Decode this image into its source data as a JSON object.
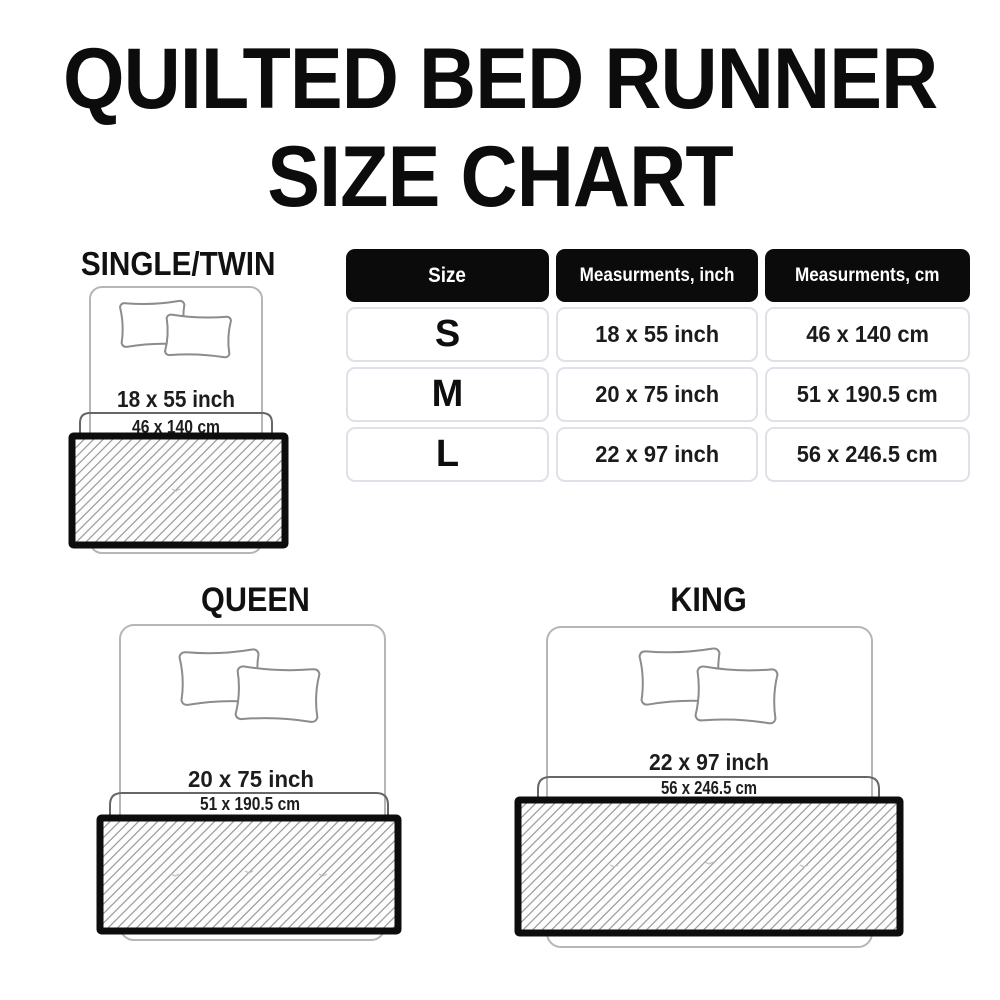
{
  "title": {
    "line1": "QUILTED BED RUNNER",
    "line2": "SIZE CHART"
  },
  "size_table": {
    "headers": {
      "size": "Size",
      "inch": "Measurments, inch",
      "cm": "Measurments, cm"
    },
    "rows": [
      {
        "size": "S",
        "inch": "18 x 55 inch",
        "cm": "46 x 140 cm"
      },
      {
        "size": "M",
        "inch": "20 x 75 inch",
        "cm": "51 x 190.5 cm"
      },
      {
        "size": "L",
        "inch": "22 x 97 inch",
        "cm": "56 x 246.5 cm"
      }
    ]
  },
  "diagrams": {
    "single": {
      "label": "SINGLE/TWIN",
      "inch": "18 x 55 inch",
      "cm": "46 x 140 cm"
    },
    "queen": {
      "label": "QUEEN",
      "inch": "20 x 75 inch",
      "cm": "51 x 190.5 cm"
    },
    "king": {
      "label": "KING",
      "inch": "22 x 97 inch",
      "cm": "56 x 246.5 cm"
    }
  },
  "colors": {
    "header_bg": "#0b0b0b",
    "header_text": "#ffffff",
    "cell_border": "#e0e1e8",
    "runner_border": "#0d0d0d",
    "hatch_line": "#9e9e9e",
    "bed_outline": "#b6b6b6",
    "pillow_outline": "#8c8c8c",
    "bracket_outline": "#666666",
    "text": "#1b1b1b"
  }
}
